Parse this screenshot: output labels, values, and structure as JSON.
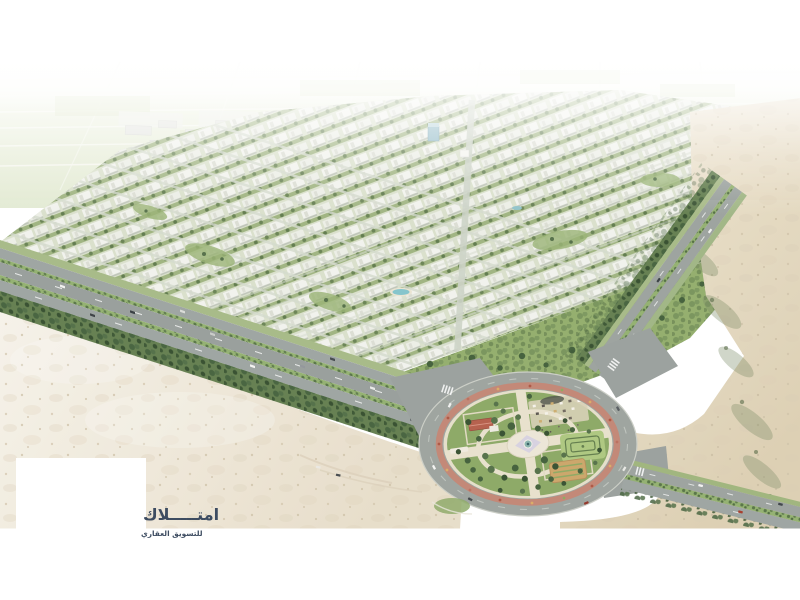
{
  "scene": {
    "kind": "aerial-3d-masterplan-render",
    "description": "Bird's-eye 3D rendering of a gated residential compound: dense rows of white villas with green courtyards, tree-lined boulevards, desert surroundings and a large circular landscaped roundabout park in the foreground",
    "palette": {
      "sky_haze": "#ffffff",
      "far_fields": "#e9eed9",
      "building_white": "#f1f2ec",
      "building_shadow": "#bcc2b5",
      "greenery": "#8fae6b",
      "tree_dark": "#3f5d37",
      "asphalt": "#99a09b",
      "sand_left": "#f3efe5",
      "sand_right": "#e2d6bd",
      "flower_ring": "#c08270",
      "park_lawn": "#87a55f",
      "park_path": "#e7e0ca",
      "red_roof": "#b25944",
      "pool_blue": "#7fc2c9",
      "maze_green": "#aac57b",
      "garden_tan": "#c9a263"
    }
  },
  "logo": {
    "brand_ar": "امتـــــلاك",
    "tagline_ar": "للتسويق العقاري",
    "color": "#3d4c61"
  }
}
